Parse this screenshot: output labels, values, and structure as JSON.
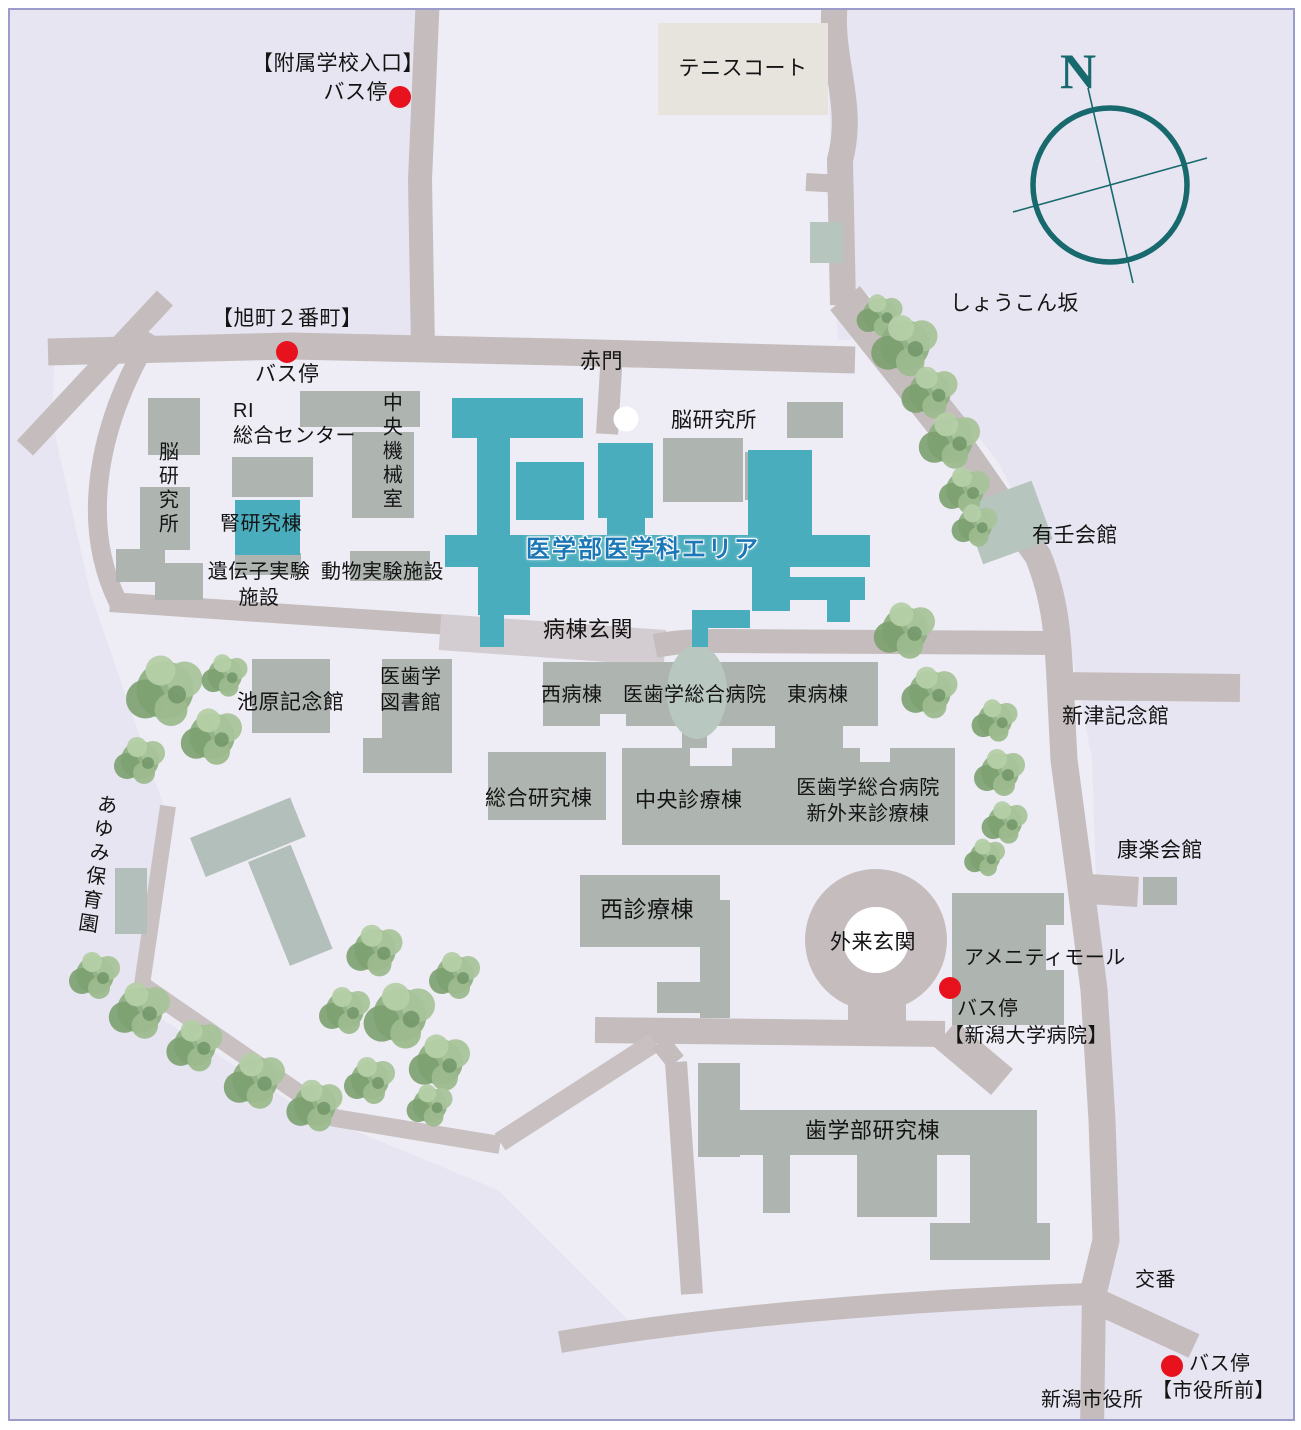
{
  "labels": {
    "fuzoku1": "【附属学校入口】",
    "fuzoku2": "バス停",
    "tennis": "テニスコート",
    "asahimachi": "【旭町２番町】",
    "asahimachi_bus": "バス停",
    "akamon": "赤門",
    "ri_center": "RI\n総合センター",
    "chuo_kikai": "中央機械室",
    "noken_left": "脳研究所",
    "jinken": "腎研究棟",
    "idenshi": "遺伝子実験\n施設",
    "dobutsu": "動物実験施設",
    "noken_right": "脳研究所",
    "igakubu_area": "医学部医学科エリア",
    "byoto_genkan": "病棟玄関",
    "shokonzaka": "しょうこん坂",
    "yujin_kaikan": "有壬会館",
    "ikehara": "池原記念館",
    "library": "医歯学\n図書館",
    "wards": "西病棟　医歯学総合病院　東病棟",
    "niitsu": "新津記念館",
    "sogo_kenkyu": "総合研究棟",
    "chuo_shinryo": "中央診療棟",
    "shin_gairai": "医歯学総合病院\n新外来診療棟",
    "koraku": "康楽会館",
    "nishi_shinryo": "西診療棟",
    "gairai_genkan": "外来玄関",
    "amenity": "アメニティモール",
    "byoin_bus": "バス停",
    "byoin_bus_name": "【新潟大学病院】",
    "ayumi": "あゆみ保育園",
    "shigakubu": "歯学部研究棟",
    "koban": "交番",
    "shiyakusho_bus": "バス停",
    "shiyakusho_bus_name": "【市役所前】",
    "shiyakusho": "新潟市役所"
  },
  "compass": {
    "north_label": "N"
  },
  "colors": {
    "background": "#e7e5f1",
    "campus": "#eeedf5",
    "road": "#c5bdbd",
    "plaza": "#d3ccd0",
    "building_gray": "#aeb5b1",
    "building_teal": "#4aadbd",
    "building_sage": "#b7c5bf",
    "tennis_court": "#e7e4de",
    "bus_stop_red": "#e8121f",
    "gate_marker_white": "#ffffff",
    "compass_teal": "#17696d",
    "area_label_blue": "#1b77b5"
  }
}
